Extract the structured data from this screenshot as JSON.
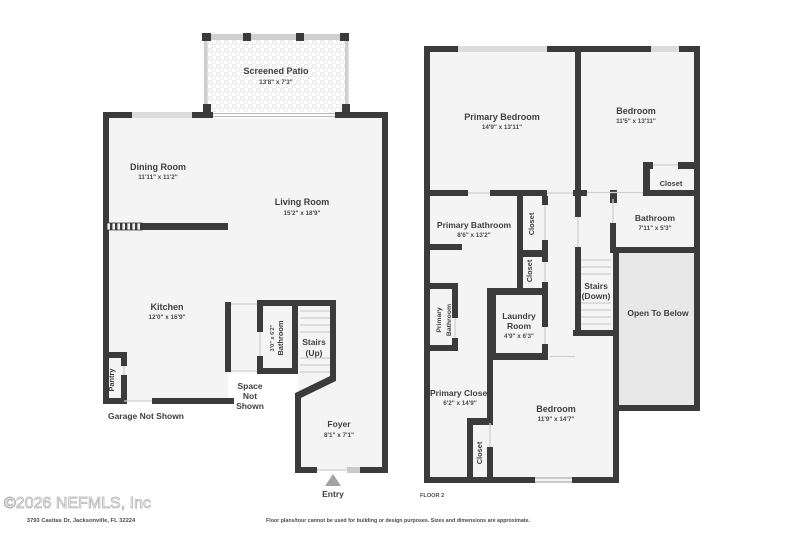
{
  "footer": {
    "copyright": "©2026 NEFMLS, Inc",
    "address": "3793 Casitas Dr, Jacksonville, FL 32224",
    "disclaimer": "Floor plans/tour cannot be used for building or design purposes. Sizes and dimensions are approximate."
  },
  "colors": {
    "wall": "#3b3b3b",
    "room_fill": "#f4f4f4",
    "open_to_below_fill": "#e8e8e8",
    "window": "#c9c9c9",
    "text": "#3f3f3f"
  },
  "floor1": {
    "screened_patio": {
      "name": "Screened Patio",
      "dims": "13'8\" x 7'3\""
    },
    "dining_room": {
      "name": "Dining Room",
      "dims": "11'11\" x 11'2\""
    },
    "living_room": {
      "name": "Living Room",
      "dims": "15'2\" x 18'9\""
    },
    "kitchen": {
      "name": "Kitchen",
      "dims": "12'0\" x 16'9\""
    },
    "bathroom": {
      "name": "Bathroom",
      "dims": "3'0\" x 6'2\""
    },
    "stairs": {
      "name": "Stairs",
      "dims": "(Up)"
    },
    "pantry": {
      "name": "Pantry"
    },
    "space_not_shown": {
      "line1": "Space",
      "line2": "Not",
      "line3": "Shown"
    },
    "garage": {
      "name": "Garage Not Shown"
    },
    "foyer": {
      "name": "Foyer",
      "dims": "8'1\" x 7'1\""
    },
    "entry": {
      "name": "Entry"
    }
  },
  "floor2": {
    "label": "FLOOR 2",
    "primary_bedroom": {
      "name": "Primary Bedroom",
      "dims": "14'9\" x 13'11\""
    },
    "bedroom_top": {
      "name": "Bedroom",
      "dims": "11'5\" x 13'11\""
    },
    "closet_top": {
      "name": "Closet"
    },
    "primary_bathroom": {
      "name": "Primary Bathroom",
      "dims": "8'6\" x 13'2\""
    },
    "closet_upper": {
      "name": "Closet"
    },
    "closet_lower": {
      "name": "Closet"
    },
    "bathroom": {
      "name": "Bathroom",
      "dims": "7'11\" x 5'3\""
    },
    "stairs": {
      "name": "Stairs",
      "dims": "(Down)"
    },
    "open_to_below": {
      "name": "Open To Below"
    },
    "primary_bathroom_small": {
      "line1": "Primary",
      "line2": "Bathroom"
    },
    "laundry": {
      "line1": "Laundry",
      "line2": "Room",
      "dims": "4'9\" x 6'3\""
    },
    "primary_closet": {
      "name": "Primary Closet",
      "dims": "6'2\" x 14'9\""
    },
    "closet_bottom": {
      "name": "Closet"
    },
    "bedroom_bottom": {
      "name": "Bedroom",
      "dims": "11'9\" x 14'7\""
    }
  }
}
